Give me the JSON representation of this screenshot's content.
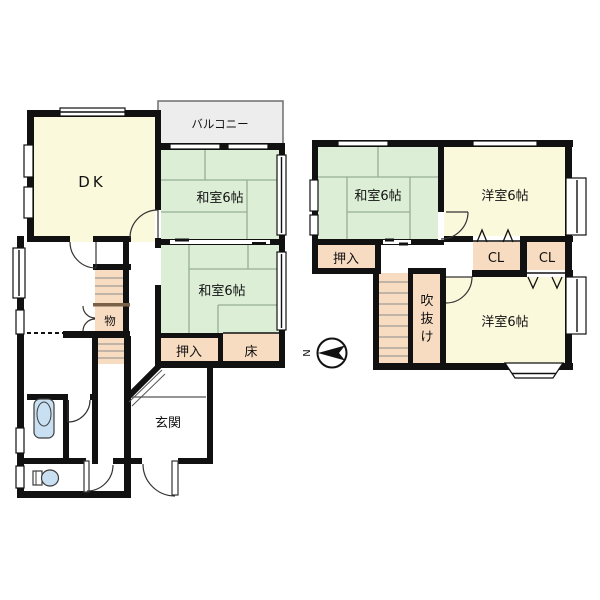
{
  "palette": {
    "wall": "#111111",
    "line": "#333333",
    "cream": "#FBF9DC",
    "green": "#DCEFD6",
    "tatami": "#96AE96",
    "peach": "#F8DCC2",
    "balcony": "#EDEDED",
    "blue": "#C9E0F2",
    "brown": "#7A6248"
  },
  "floor1": {
    "balcony_label": "バルコニー",
    "dk_label": "DK",
    "washitsu_top_label": "和室6帖",
    "washitsu_bottom_label": "和室6帖",
    "oshiire_label": "押入",
    "tokonoma_label": "床",
    "storage_label": "物",
    "genkan_label": "玄関"
  },
  "floor2": {
    "washitsu_label": "和室6帖",
    "yoshitsu_top_label": "洋室6帖",
    "yoshitsu_bottom_label": "洋室6帖",
    "oshiire_label": "押入",
    "closet_left_label": "CL",
    "closet_right_label": "CL",
    "void_chars": [
      "吹",
      "抜",
      "け"
    ]
  },
  "compass": {
    "north_label": "N"
  }
}
